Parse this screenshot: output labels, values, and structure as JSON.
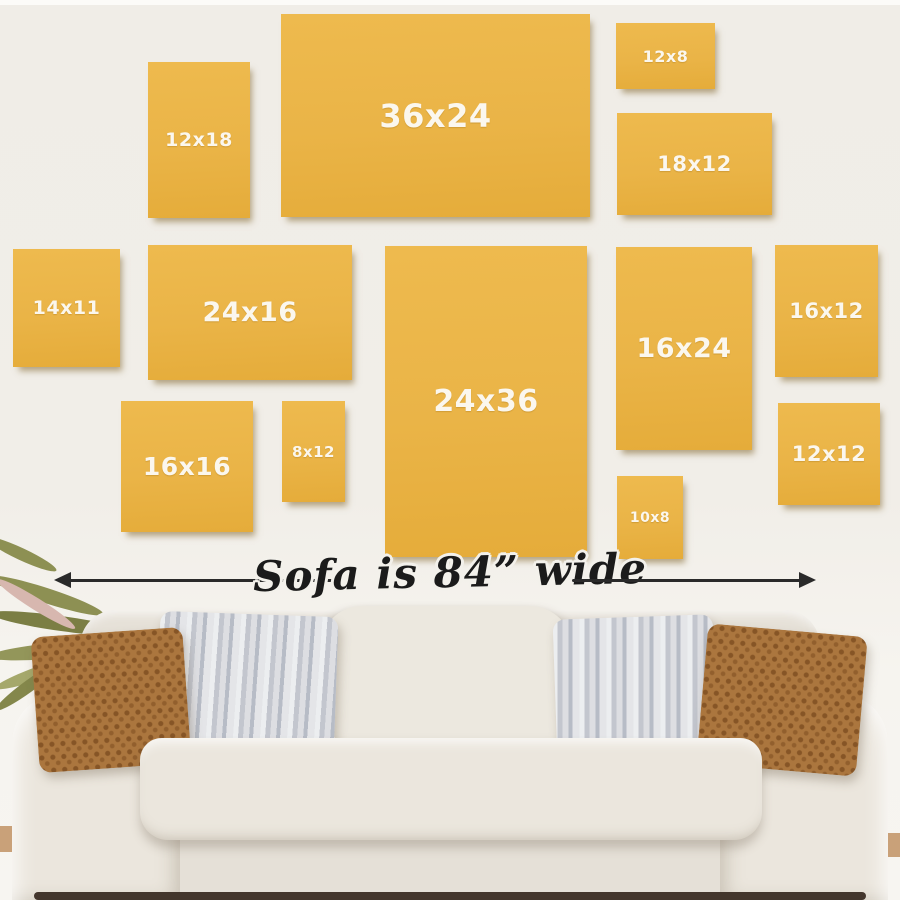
{
  "canvases": [
    {
      "label": "12x18"
    },
    {
      "label": "36x24"
    },
    {
      "label": "12x8"
    },
    {
      "label": "18x12"
    },
    {
      "label": "14x11"
    },
    {
      "label": "24x16"
    },
    {
      "label": "24x36"
    },
    {
      "label": "16x24"
    },
    {
      "label": "16x12"
    },
    {
      "label": "16x16"
    },
    {
      "label": "8x12"
    },
    {
      "label": "12x12"
    },
    {
      "label": "10x8"
    }
  ],
  "measure": {
    "caption": "Sofa is 84” wide"
  },
  "colors": {
    "canvas_fill": "#eab447",
    "canvas_label": "#fbf7ee",
    "wall": "#f0ede7",
    "arrow": "#2a2a2a",
    "sofa_fabric": "#e8e3da",
    "pillow_brown": "#ab763e",
    "pillow_gray": "#c3c6ce"
  }
}
